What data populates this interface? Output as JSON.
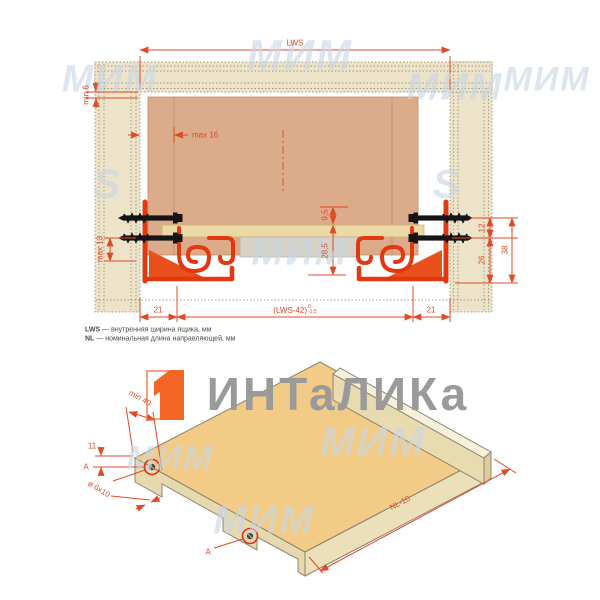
{
  "brand": {
    "title": "ИНТаЛИКа",
    "colors": {
      "brand_orange": "#f26522",
      "dimension_red": "#e04a26",
      "watermark_blue": "#c9d7e6",
      "title_gray": "#9a9a9a"
    }
  },
  "watermark": {
    "mim": "МИМ",
    "s": "S"
  },
  "top_view": {
    "labels": {
      "lws": "LWS",
      "min6": "min 6",
      "max16": "max 16",
      "h95": "9,5",
      "h285": "28,5",
      "max13": "max 13",
      "d12": "12",
      "d26": "26",
      "d38": "38",
      "side21_left": "21",
      "side21_right": "21",
      "lws42": "(LWS-42)",
      "tol_top": "0",
      "tol_bottom": "-1,5"
    },
    "legend": [
      {
        "term": "LWS",
        "text": " — внутренняя ширина ящика, мм"
      },
      {
        "term": "NL",
        "text": " — номинальная длина направляющей, мм"
      }
    ]
  },
  "iso_view": {
    "labels": {
      "min40": "min 40",
      "t11": "11",
      "hole": "ø 6x10",
      "detail_a1": "A",
      "detail_a2": "A",
      "nl10": "NL-10"
    }
  }
}
